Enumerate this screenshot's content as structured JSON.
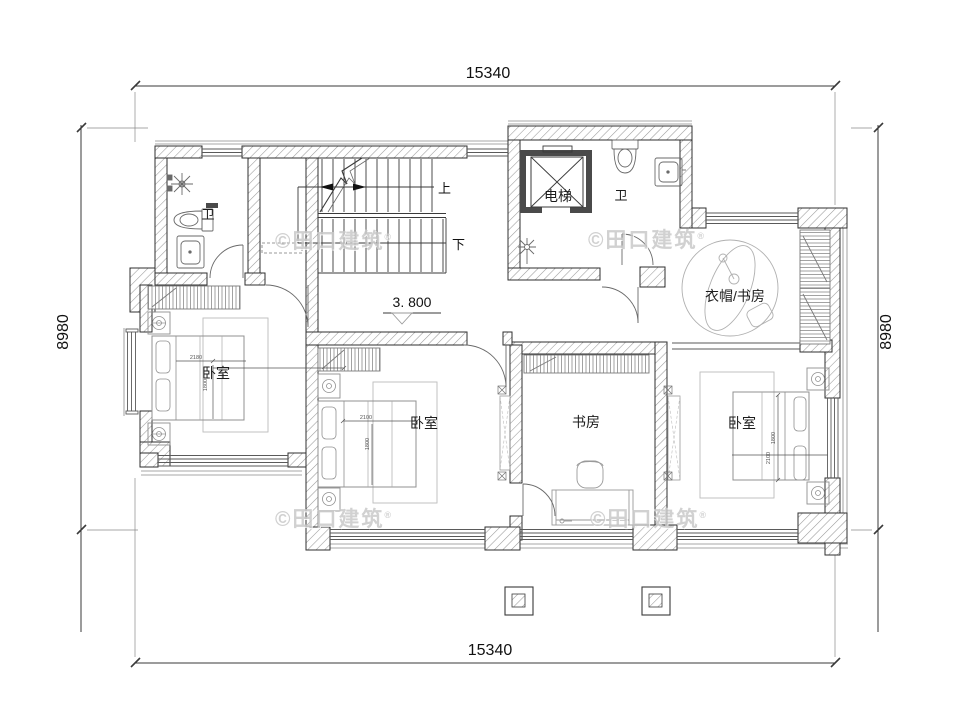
{
  "dimensions": {
    "top": "15340",
    "bottom": "15340",
    "left": "8980",
    "right": "8980"
  },
  "level": {
    "value": "3. 800"
  },
  "stairs": {
    "up_label": "上",
    "down_label": "下"
  },
  "rooms": {
    "bath_left": "卫",
    "bath_top": "卫",
    "elevator": "电梯",
    "cloak_study": "衣帽/书房",
    "bedroom_left": "卧室",
    "bedroom_middle": "卧室",
    "study": "书房",
    "bedroom_right": "卧室"
  },
  "furniture_dims": {
    "bed_left_w": "2180",
    "bed_left_d": "1800",
    "bed_mid_w": "2100",
    "bed_mid_d": "1800",
    "bed_right_d": "1800",
    "bed_right_w": "2100"
  },
  "watermark": {
    "text": "©田口建筑",
    "reg": "®"
  },
  "colors": {
    "wall_line": "#2f2f2f",
    "furniture_line": "#909090",
    "watermark": "#c9c9c9"
  }
}
